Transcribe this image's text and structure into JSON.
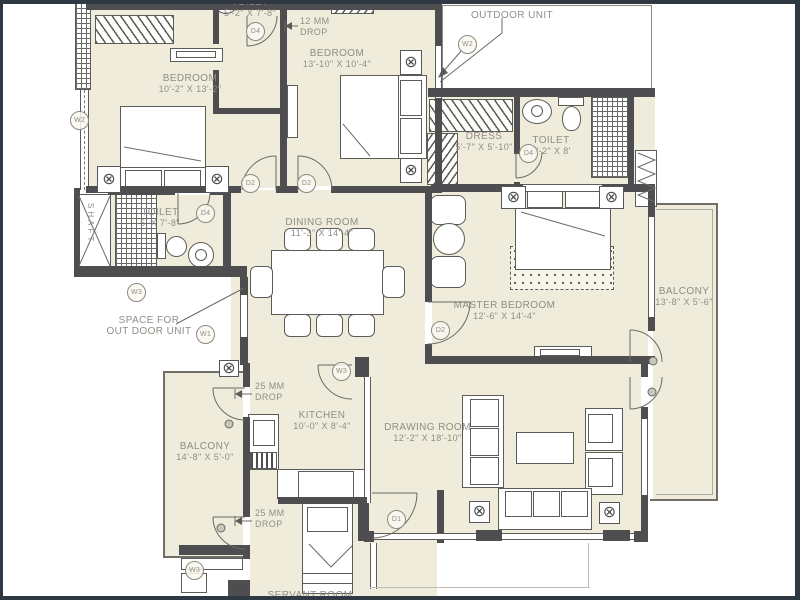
{
  "palette": {
    "frame": "#2e3944",
    "floor": "#f0ecdc",
    "wall": "#4e4e50",
    "line": "#5b5b58",
    "text": "#8f8e86"
  },
  "rooms": {
    "bedroom1": {
      "name": "BEDROOM",
      "dims": "10'-2\" X 13'-2\""
    },
    "toilet1": {
      "name": "TOILET",
      "dims": "5'-2\" X 7'-8\""
    },
    "bedroom2": {
      "name": "BEDROOM",
      "dims": "13'-10\" X 10'-4\""
    },
    "outdoor_unit": {
      "name": "OUTDOOR UNIT"
    },
    "dress": {
      "name": "DRESS",
      "dims": "5'-7\" X 5'-10\""
    },
    "toilet2": {
      "name": "TOILET",
      "dims": "5'-2\" X 8'"
    },
    "toilet3": {
      "name": "TOILET",
      "dims": "5' X 7'-8\""
    },
    "dining": {
      "name": "DINING ROOM",
      "dims": "11'-3\" X 14'-4\""
    },
    "master": {
      "name": "MASTER BEDROOM",
      "dims": "12'-6\" X 14'-4\""
    },
    "balcony_right": {
      "name": "BALCONY",
      "dims": "13'-8\" X 5'-6\""
    },
    "balcony_left": {
      "name": "BALCONY",
      "dims": "14'-8\" X 5'-0\""
    },
    "kitchen": {
      "name": "KITCHEN",
      "dims": "10'-0\" X 8'-4\""
    },
    "drawing": {
      "name": "DRAWING ROOM",
      "dims": "12'-2\" X 18'-10\""
    },
    "servant": {
      "name": "SERVANT ROOM"
    },
    "shaft": {
      "name": "SHAFT"
    },
    "outdoor_space": {
      "line1": "SPACE FOR",
      "line2": "OUT DOOR UNIT"
    }
  },
  "annotations": {
    "drop12": {
      "line1": "12 MM",
      "line2": "DROP"
    },
    "drop25": {
      "line1": "25 MM",
      "line2": "DROP"
    }
  },
  "markers": {
    "d1": "D1",
    "d2": "D2",
    "d4": "D4",
    "w1": "W1",
    "w2": "W2",
    "w3": "W3"
  },
  "icons": {
    "ceiling_light": "⊗"
  }
}
